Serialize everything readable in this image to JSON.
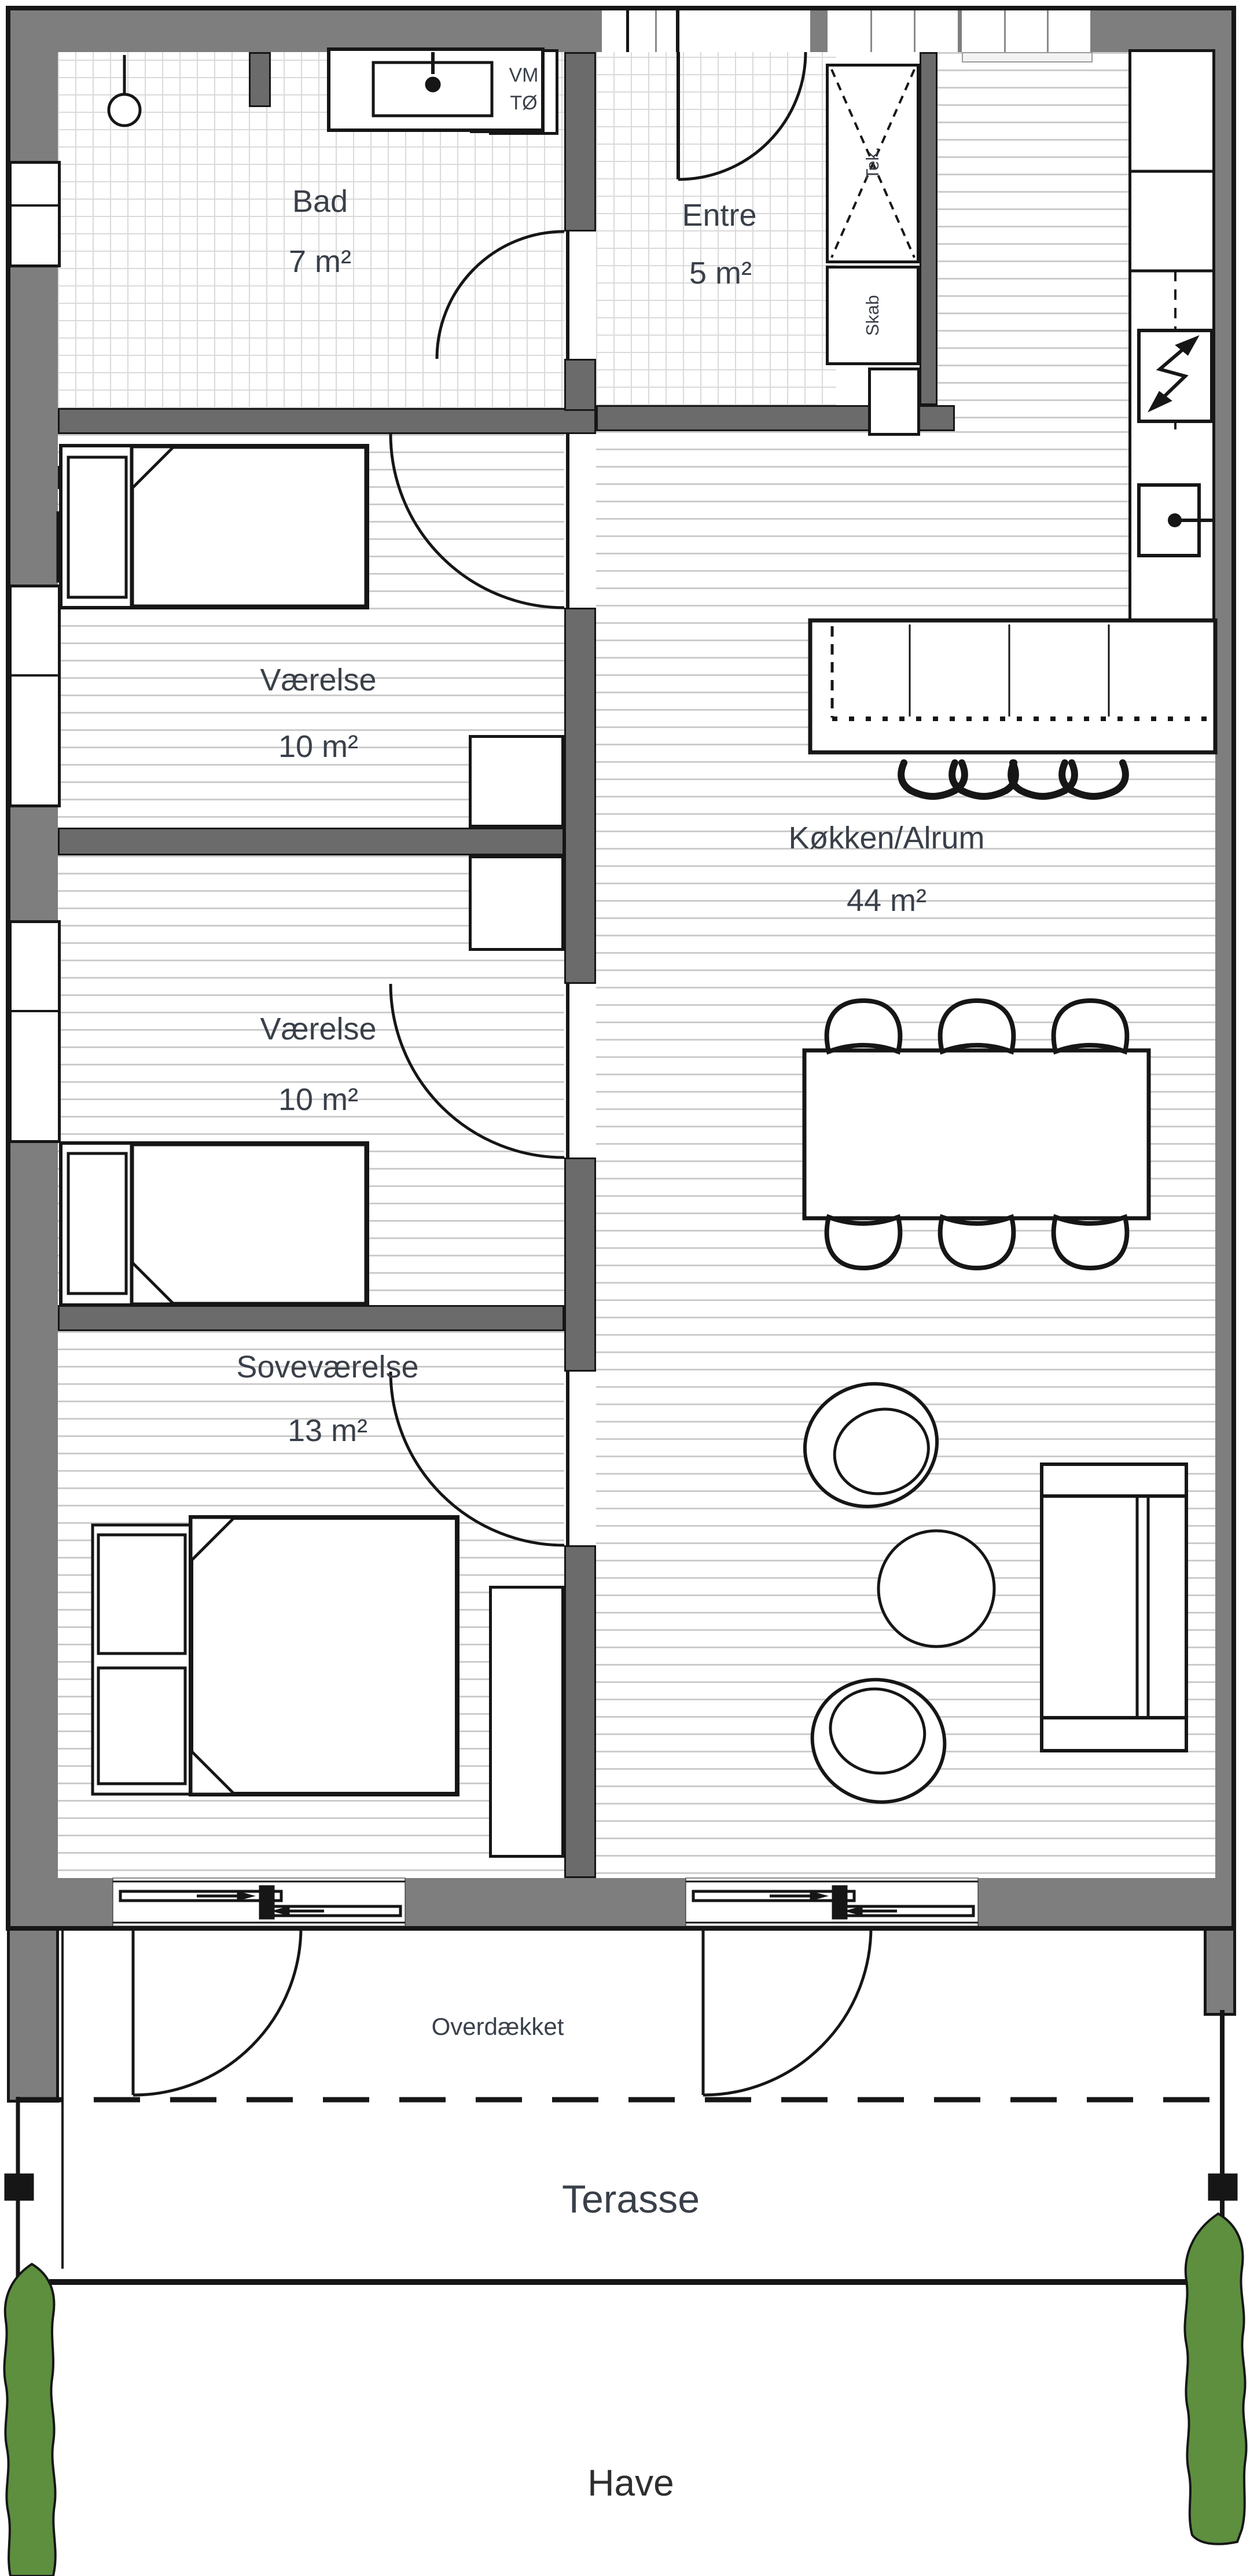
{
  "plan": {
    "title": "Floor plan",
    "rooms": [
      {
        "id": "bad",
        "name": "Bad",
        "area": "7 m²"
      },
      {
        "id": "entre",
        "name": "Entre",
        "area": "5 m²"
      },
      {
        "id": "vaerelse-1",
        "name": "Værelse",
        "area": "10 m²"
      },
      {
        "id": "vaerelse-2",
        "name": "Værelse",
        "area": "10 m²"
      },
      {
        "id": "sovevaerelse",
        "name": "Soveværelse",
        "area": "13 m²"
      },
      {
        "id": "koekken",
        "name": "Køkken/Alrum",
        "area": "44 m²"
      }
    ],
    "closets": {
      "tek": "Tek.",
      "skab": "Skab",
      "vm": "VM",
      "toe": "TØ"
    },
    "outdoor": {
      "overdaekket": "Overdækket",
      "terasse": "Terasse",
      "have": "Have"
    },
    "icons": [
      "shower-icon",
      "toilet-icon",
      "sink-icon",
      "appliance-bolt-icon",
      "kitchen-sink-icon",
      "door-arc-icon",
      "sliding-door-icon",
      "bar-stool-icon",
      "dining-chair-icon",
      "lounge-chair-icon",
      "coffee-table-icon",
      "sofa-icon",
      "bed-icon",
      "hedge-icon"
    ],
    "colors": {
      "exterior_wall": "#7e7e7e",
      "interior_wall": "#6b6b6b",
      "outline": "#161616",
      "label_text": "#3a4049",
      "hedge_green": "#5d8f3f",
      "hedge_edge": "#47732e",
      "wood_line": "#cccccc",
      "tile_line": "#dadada"
    }
  }
}
